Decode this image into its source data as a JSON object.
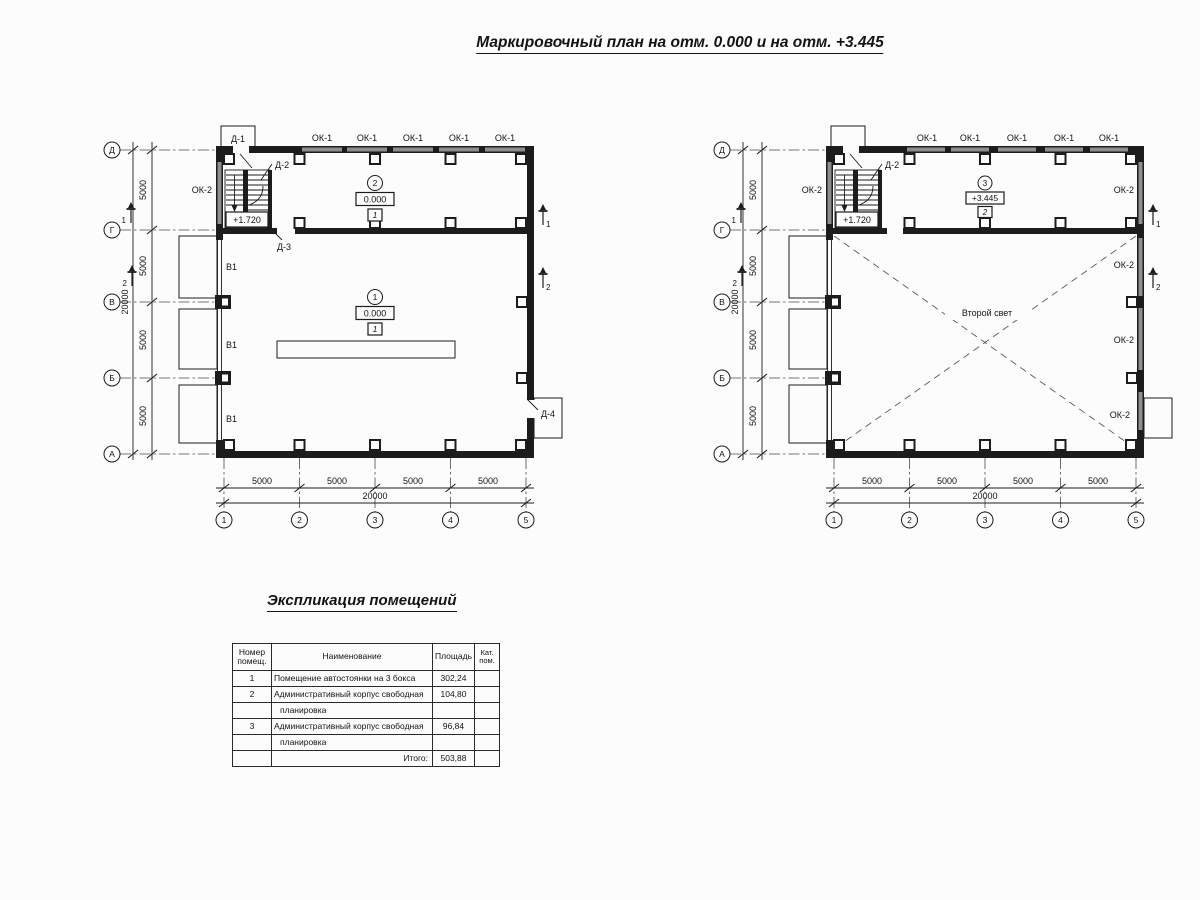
{
  "title": "Маркировочный план на отм. 0.000 и на отм. +3.445",
  "colors": {
    "ink": "#1c1c1c",
    "window_gray": "#8e8e8e"
  },
  "plan_labels": {
    "ok1": "ОК-1",
    "ok2": "ОК-2",
    "d1": "Д-1",
    "d2": "Д-2",
    "d3": "Д-3",
    "d4": "Д-4",
    "v1": "В1",
    "stair_level": "+1.720",
    "second_light": "Второй свет",
    "dim_5000": "5000",
    "dim_20000": "20000"
  },
  "axes": {
    "rows": [
      "Д",
      "Г",
      "В",
      "Б",
      "А"
    ],
    "cols": [
      "1",
      "2",
      "3",
      "4",
      "5"
    ]
  },
  "sections": {
    "s1": "1",
    "s2": "2"
  },
  "rooms": {
    "r1": {
      "num": "1",
      "level": "0.000",
      "floor": "1"
    },
    "r2": {
      "num": "2",
      "level": "0.000",
      "floor": "1"
    },
    "r3": {
      "num": "3",
      "level": "+3.445",
      "floor": "2"
    }
  },
  "schedule": {
    "title": "Экспликация помещений",
    "headers": {
      "num": "Номер\nпомещ.",
      "name": "Наименование",
      "area": "Площадь",
      "cat": "Кат.\nпом."
    },
    "rows": [
      {
        "num": "1",
        "name": "Помещение автостоянки на 3 бокса",
        "area": "302,24",
        "cat": ""
      },
      {
        "num": "2",
        "name": "Административный корпус свободная",
        "area": "104,80",
        "cat": ""
      },
      {
        "num": "",
        "name": "планировка",
        "area": "",
        "cat": ""
      },
      {
        "num": "3",
        "name": "Административный корпус свободная",
        "area": "96,84",
        "cat": ""
      },
      {
        "num": "",
        "name": "планировка",
        "area": "",
        "cat": ""
      },
      {
        "num": "",
        "name": "Итого:",
        "area": "503,88",
        "cat": ""
      }
    ]
  }
}
